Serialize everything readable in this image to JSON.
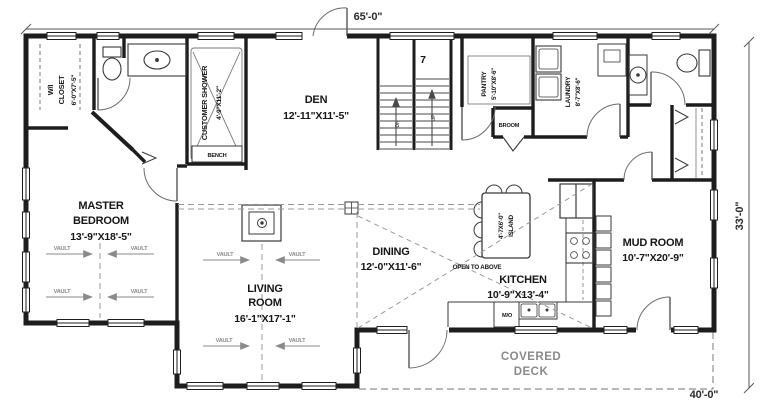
{
  "plan": {
    "dimensions": {
      "width": "65'-0\"",
      "depth": "33'-0\"",
      "deck_width": "40'-0\""
    },
    "rooms": {
      "master": {
        "l1": "MASTER",
        "l2": "BEDROOM",
        "size": "13'-9\"X18'-5\""
      },
      "living": {
        "l1": "LIVING",
        "l2": "ROOM",
        "size": "16'-1\"X17'-1\""
      },
      "den": {
        "name": "DEN",
        "size": "12'-11\"X11'-5\""
      },
      "dining": {
        "name": "DINING",
        "size": "12'-0\"X11'-6\""
      },
      "kitchen": {
        "name": "KITCHEN",
        "size": "10'-9\"X13'-4\""
      },
      "mud": {
        "name": "MUD ROOM",
        "size": "10'-7\"X20'-9\""
      },
      "wic": {
        "l1": "W/I",
        "l2": "CLOSET",
        "size": "6'-0\"X7'-5\""
      },
      "shower": {
        "name": "CUSTOMER SHOWER",
        "size": "4'-9\"X11'-2\""
      },
      "pantry": {
        "name": "PANTRY",
        "size": "5'-10\"X8'-6\""
      },
      "laundry": {
        "name": "LAUNDRY",
        "size": "8'-7\"X8'-6\""
      },
      "island": {
        "size": "4'-7X6'-0\"",
        "name": "ISLAND"
      },
      "deck": {
        "l1": "COVERED",
        "l2": "DECK"
      }
    },
    "labels": {
      "vault": "VAULT",
      "bench": "BENCH",
      "broom": "BROOM",
      "open_above": "OPEN TO ABOVE",
      "appliance": "M/O",
      "dn": "DN",
      "up": "UP",
      "stair_note": "7"
    }
  }
}
